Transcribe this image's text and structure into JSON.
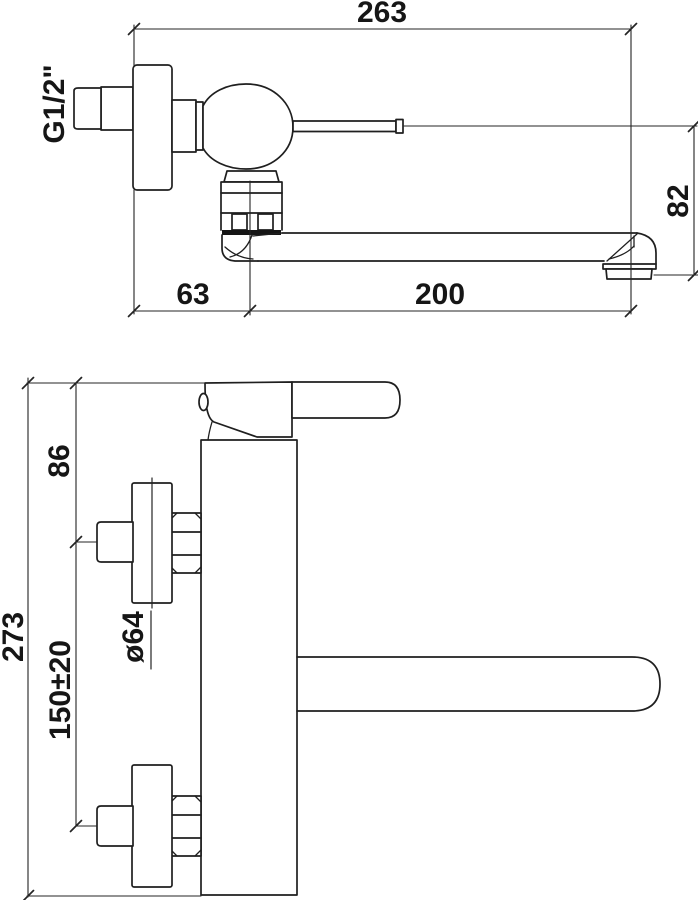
{
  "drawing": {
    "type": "technical-dimension-drawing",
    "subject": "wall-mounted single-lever mixer faucet, two orthographic views with dimensions in mm",
    "line_color": "#1f1f1f",
    "background_color": "#ffffff",
    "top_view": {
      "name": "side view",
      "dims": {
        "overall_depth": "263",
        "inlet_thread": "G1/2\"",
        "spout_height_drop": "82",
        "wall_to_body_axis": "63",
        "spout_reach": "200"
      }
    },
    "front_view": {
      "name": "front view",
      "dims": {
        "body_top_to_inlet_axis": "86",
        "inlet_centers_spacing": "150±20",
        "escutcheon_diameter": "ø64",
        "overall_height": "273"
      }
    }
  }
}
